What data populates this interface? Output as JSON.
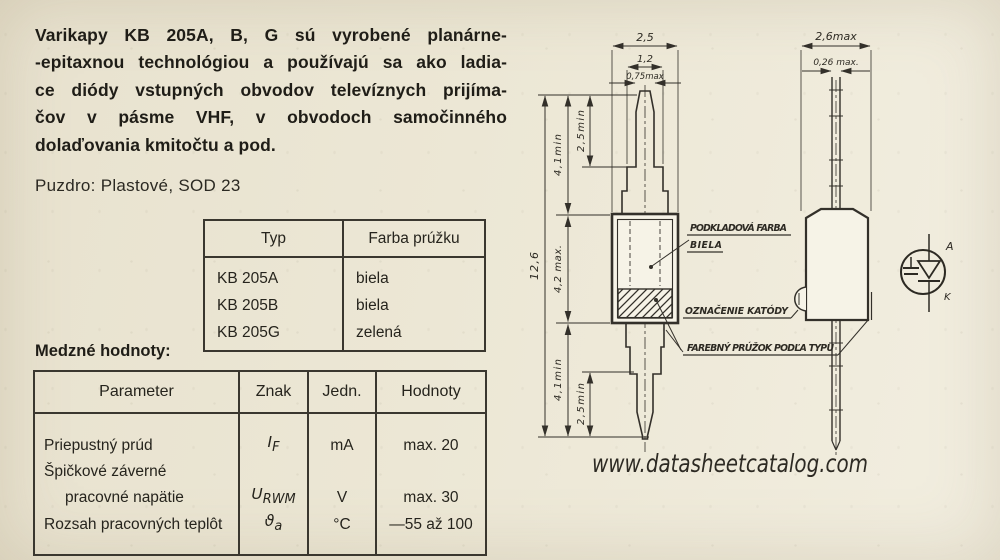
{
  "paragraph": {
    "line1": "Varikapy KB 205A, B, G sú vyrobené planárne-",
    "line2": "-epitaxnou technológiou a používajú sa ako ladia-",
    "line3": "ce diódy vstupných obvodov televíznych prijíma-",
    "line4": "čov v pásme VHF, v obvodoch samočinného",
    "line5": "dolaďovania kmitočtu a pod."
  },
  "package_line": "Puzdro: Plastové, SOD 23",
  "type_table": {
    "header_typ": "Typ",
    "header_farba": "Farba prúžku",
    "rows": [
      {
        "typ": "KB 205A",
        "farba": "biela"
      },
      {
        "typ": "KB 205B",
        "farba": "biela"
      },
      {
        "typ": "KB 205G",
        "farba": "zelená"
      }
    ]
  },
  "limits": {
    "title": "Medzné hodnoty:",
    "header": {
      "parameter": "Parameter",
      "znak": "Znak",
      "jedn": "Jedn.",
      "hodnoty": "Hodnoty"
    },
    "row1": {
      "parameter": "Priepustný prúd",
      "symbol": "I",
      "symbol_sub": "F",
      "unit": "mA",
      "value": "max. 20"
    },
    "row2": {
      "parameter_line1": "Špičkové záverné",
      "parameter_line2": "pracovné napätie",
      "symbol": "U",
      "symbol_sub": "RWM",
      "unit": "V",
      "value": "max. 30"
    },
    "row3": {
      "parameter": "Rozsah pracovných teplôt",
      "symbol": "ϑ",
      "symbol_sub": "a",
      "unit": "°C",
      "value": "—55 až 100"
    }
  },
  "drawing": {
    "front": {
      "dim_body_width": "2,5",
      "dim_shoulder_width": "1,2",
      "dim_blade_width": "0,75max",
      "dim_total_length": "12,6",
      "dim_lead_top": "4,1min",
      "dim_blade_top": "2,5min",
      "dim_body_height": "4,2 max.",
      "dim_lead_bottom": "4,1min",
      "dim_blade_bottom": "2,5min"
    },
    "side": {
      "dim_body_width": "2,6max",
      "dim_lead_width": "0,26 max."
    },
    "callouts": {
      "base_color_line1": "PODKLADOVÁ FARBA",
      "base_color_line2": "BIELA",
      "cathode_mark": "OZNAČENIE KATÓDY",
      "stripe": "FAREBNÝ PRÚŽOK PODĽA TYPU"
    },
    "symbol": {
      "anode": "A",
      "cathode": "K"
    }
  },
  "watermark": "www.datasheetcatalog.com"
}
